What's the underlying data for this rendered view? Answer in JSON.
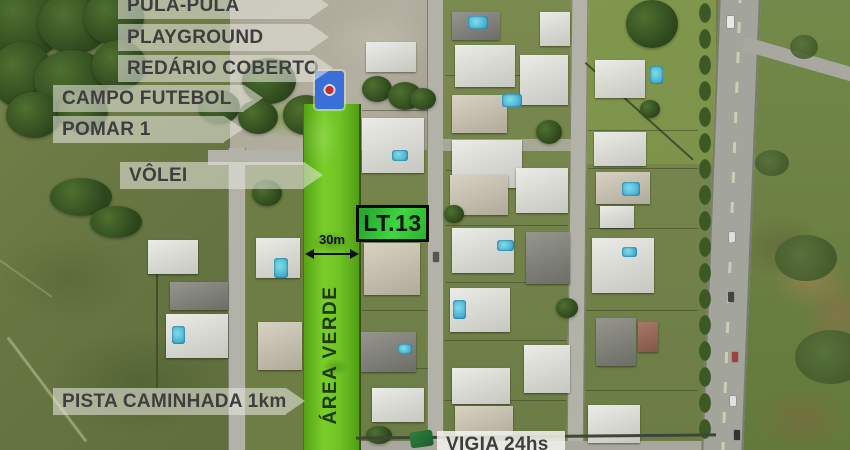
{
  "map": {
    "type": "satellite-annotated",
    "amenity_labels": {
      "pula_pula": "PULA-PULA",
      "playground": "PLAYGROUND",
      "redario_coberto": "REDÁRIO COBERTO",
      "campo_futebol": "CAMPO FUTEBOL",
      "pomar": "POMAR 1",
      "volei": "VÔLEI",
      "pista_caminhada": "PISTA CAMINHADA 1km",
      "vigia": "VIGIA 24hs"
    },
    "lot": {
      "id": "LT.13",
      "frontage": "30m"
    },
    "green_area_label": "ÁREA VERDE",
    "colors": {
      "highlight_green": "#6ec324",
      "lot_box_green": "#2fbf2f",
      "banner_background": "#e5e5dd",
      "banner_text": "#3e3e3e",
      "area_verde_text": "#1e3806"
    }
  }
}
